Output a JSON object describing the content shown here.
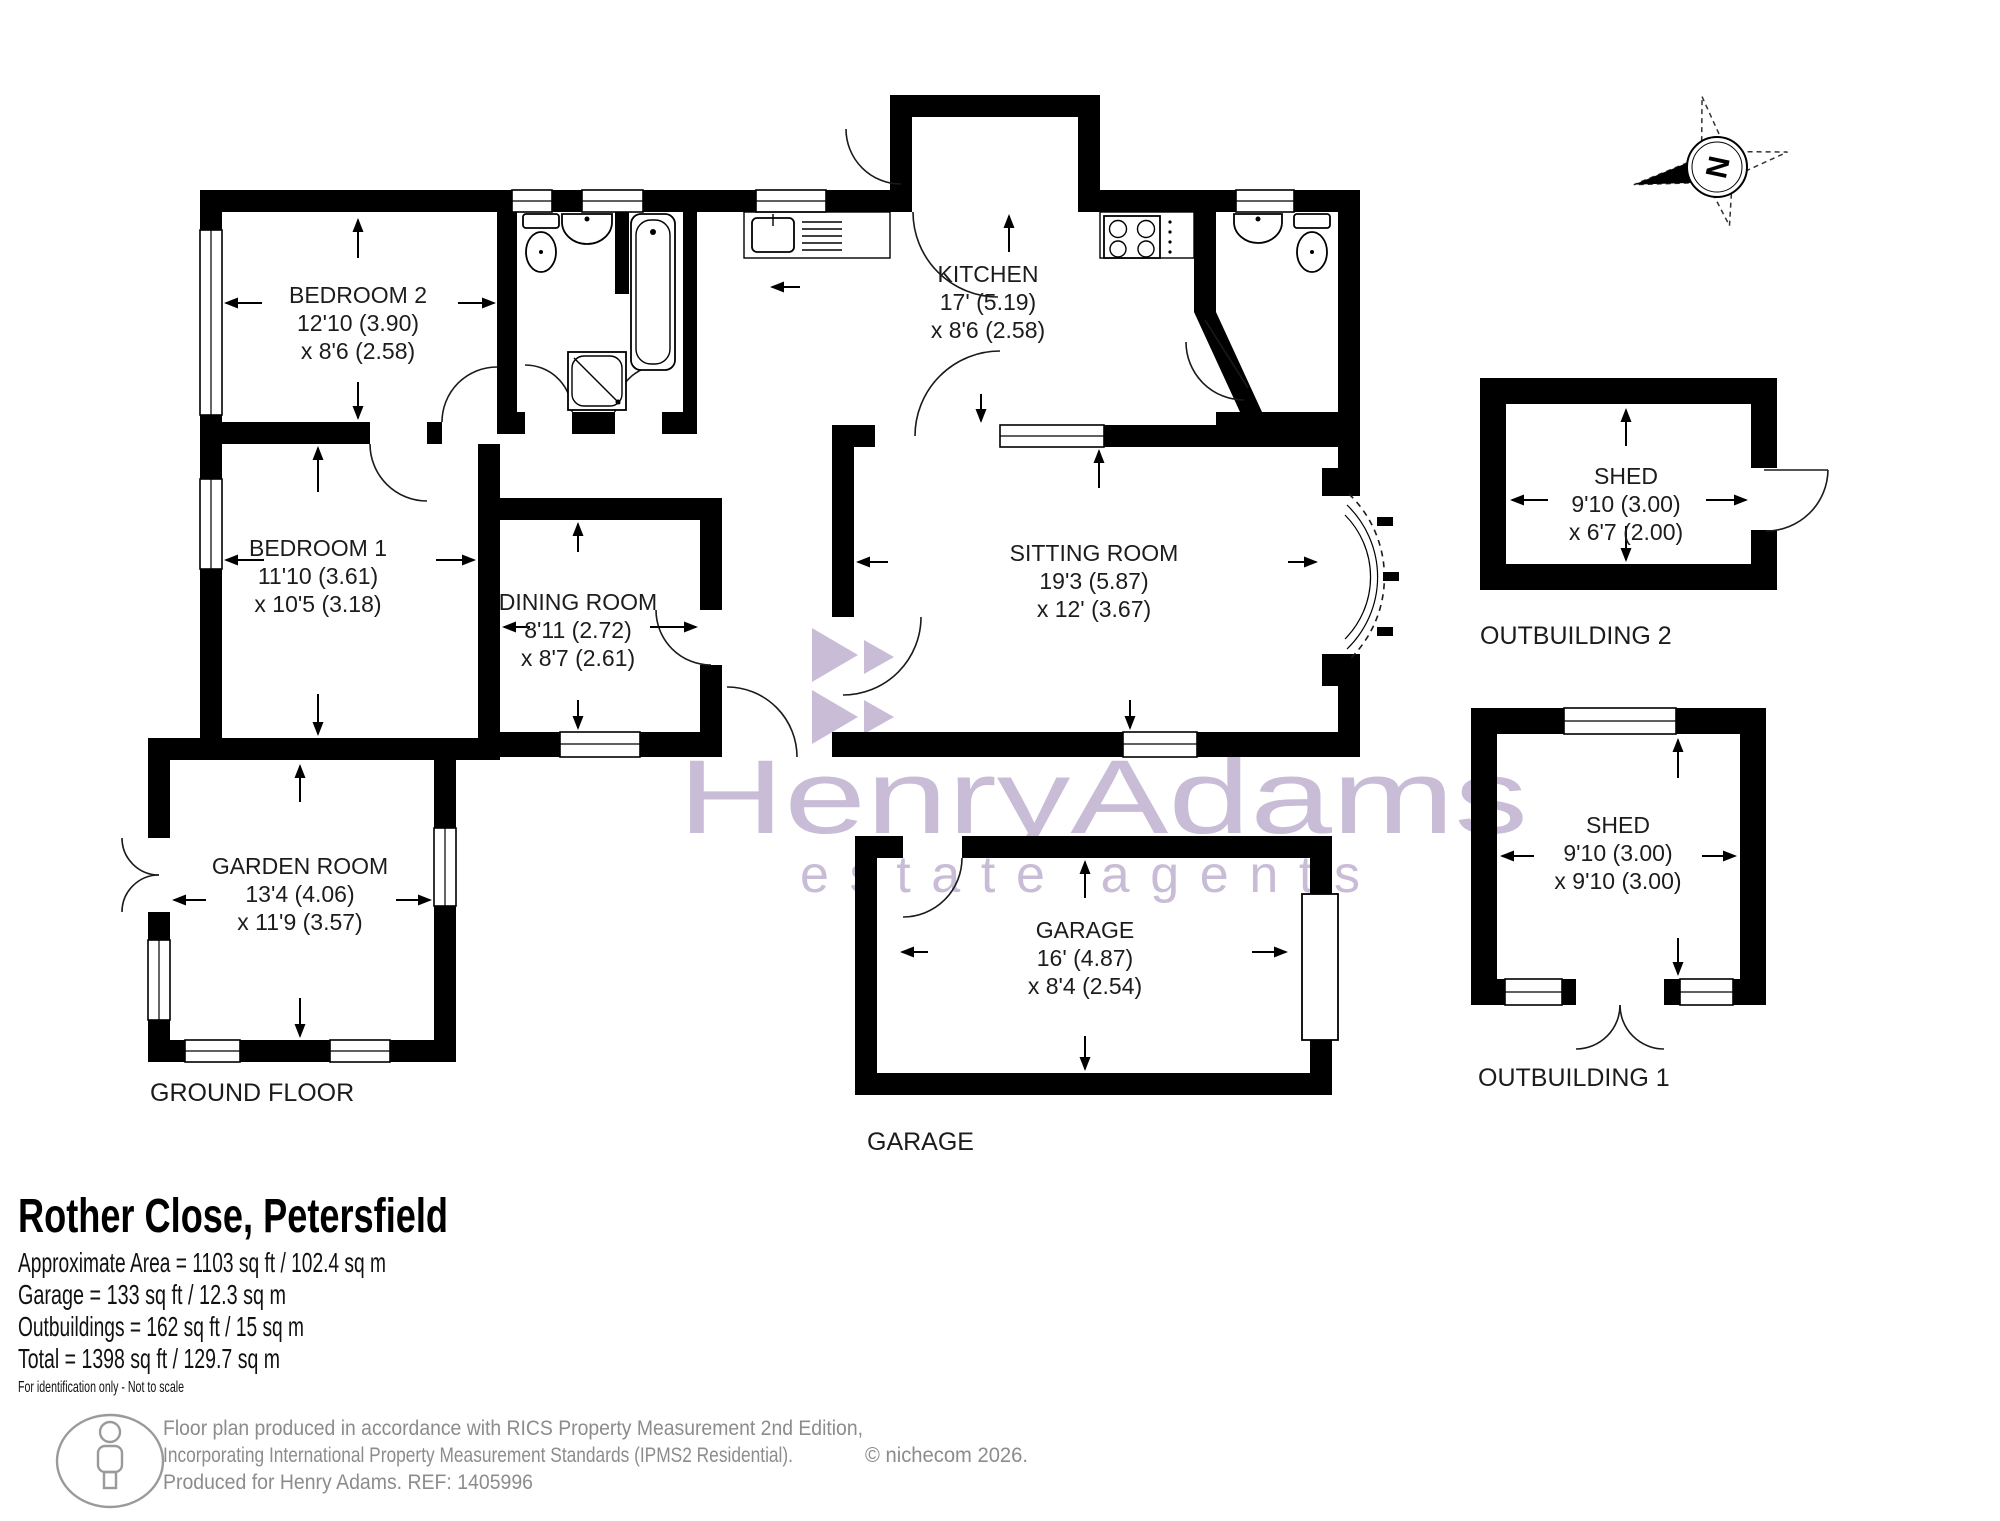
{
  "plan": {
    "watermark": {
      "line1": "HenryAdams",
      "line2": "estate agents",
      "color": "#c9bcd7"
    },
    "compass": {
      "label": "N"
    },
    "rooms": {
      "bedroom2": {
        "name": "BEDROOM 2",
        "dim1": "12'10 (3.90)",
        "dim2": "x 8'6 (2.58)"
      },
      "bedroom1": {
        "name": "BEDROOM 1",
        "dim1": "11'10 (3.61)",
        "dim2": "x 10'5 (3.18)"
      },
      "dining": {
        "name": "DINING ROOM",
        "dim1": "8'11 (2.72)",
        "dim2": "x 8'7 (2.61)"
      },
      "kitchen": {
        "name": "KITCHEN",
        "dim1": "17' (5.19)",
        "dim2": "x 8'6 (2.58)"
      },
      "sitting": {
        "name": "SITTING ROOM",
        "dim1": "19'3 (5.87)",
        "dim2": "x 12' (3.67)"
      },
      "garden": {
        "name": "GARDEN ROOM",
        "dim1": "13'4 (4.06)",
        "dim2": "x 11'9 (3.57)"
      },
      "garage": {
        "name": "GARAGE",
        "dim1": "16' (4.87)",
        "dim2": "x 8'4 (2.54)"
      },
      "shed2": {
        "name": "SHED",
        "dim1": "9'10 (3.00)",
        "dim2": "x 6'7 (2.00)"
      },
      "shed1": {
        "name": "SHED",
        "dim1": "9'10 (3.00)",
        "dim2": "x 9'10 (3.00)"
      }
    },
    "labels": {
      "ground_floor": "GROUND FLOOR",
      "garage": "GARAGE",
      "outbuilding2": "OUTBUILDING 2",
      "outbuilding1": "OUTBUILDING 1"
    }
  },
  "summary": {
    "title": "Rother Close, Petersfield",
    "lines": [
      "Approximate Area = 1103 sq ft / 102.4 sq m",
      "Garage = 133 sq ft / 12.3 sq m",
      "Outbuildings = 162 sq ft / 15 sq m",
      "Total = 1398 sq ft / 129.7 sq m"
    ],
    "note": "For identification only - Not to scale"
  },
  "footer": {
    "line1": "Floor plan produced in accordance with RICS Property Measurement 2nd Edition,",
    "line2": "Incorporating International Property Measurement Standards (IPMS2 Residential).",
    "copyright": "© nichecom 2026.",
    "line3": "Produced for Henry Adams.   REF: 1405996"
  }
}
